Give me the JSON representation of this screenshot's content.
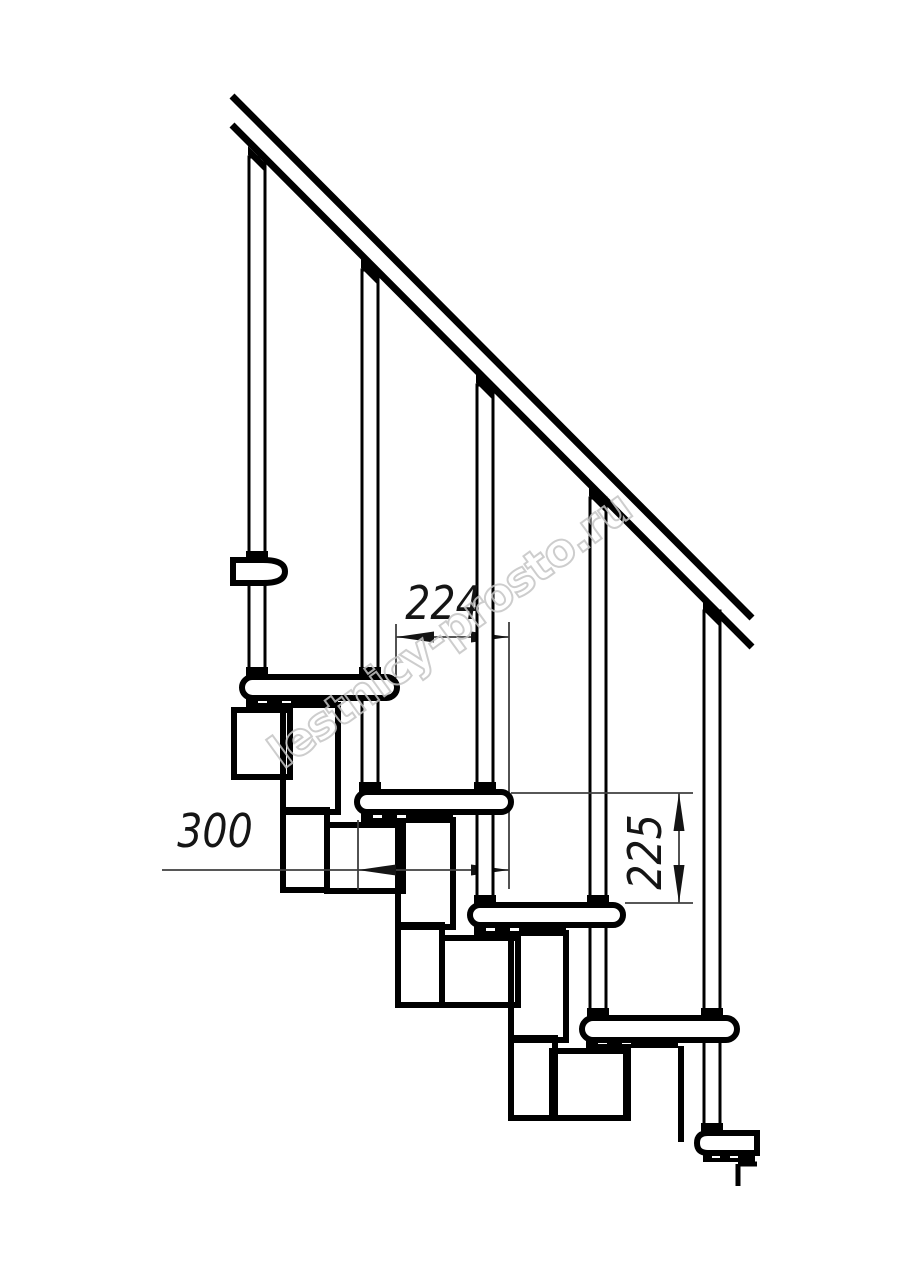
{
  "drawing": {
    "dimensions": {
      "step_run": "224",
      "tread_depth": "300",
      "step_rise": "225"
    },
    "watermark": "lestnicy-prosto.ru",
    "colors": {
      "line": "#000000",
      "dimension_line": "#3f3f3f",
      "dimension_text": "#151515",
      "watermark_outline": "#c5c5c5",
      "background": "#ffffff"
    }
  }
}
